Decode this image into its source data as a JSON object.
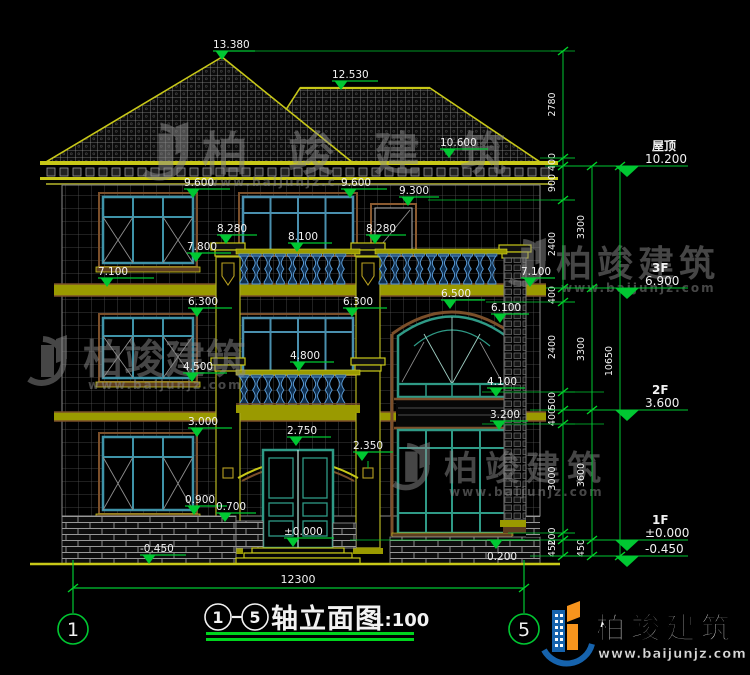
{
  "title": {
    "axis_from": "1",
    "axis_to": "5",
    "name": "轴立面图",
    "scale": "1:100"
  },
  "brand": {
    "name": "柏竣建筑",
    "url": "www.baijunjz.com",
    "url_short": "www.baijunjz.c"
  },
  "axes": [
    {
      "label": "1",
      "x": 73
    },
    {
      "label": "5",
      "x": 524
    }
  ],
  "floors": [
    {
      "name": "屋顶",
      "elev": "10.200",
      "line_y": 166
    },
    {
      "name": "3F",
      "elev": "6.900",
      "line_y": 288
    },
    {
      "name": "2F",
      "elev": "3.600",
      "line_y": 410
    },
    {
      "name": "1F",
      "elev": "±0.000",
      "line_y": 540
    },
    {
      "name": "",
      "elev": "-0.450",
      "line_y": 556
    }
  ],
  "markers": [
    {
      "label": "13.380",
      "x": 222,
      "y": 51,
      "len": 42
    },
    {
      "label": "12.530",
      "x": 341,
      "y": 81,
      "len": 46
    },
    {
      "label": "10.600",
      "x": 449,
      "y": 149,
      "len": 48
    },
    {
      "label": "9.600",
      "x": 193,
      "y": 189,
      "len": 46
    },
    {
      "label": "9.600",
      "x": 350,
      "y": 189,
      "len": 46
    },
    {
      "label": "9.300",
      "x": 408,
      "y": 197,
      "len": 40
    },
    {
      "label": "8.280",
      "x": 226,
      "y": 235,
      "len": 40
    },
    {
      "label": "8.100",
      "x": 297,
      "y": 243,
      "len": 44
    },
    {
      "label": "8.280",
      "x": 375,
      "y": 235,
      "len": 40
    },
    {
      "label": "7.800",
      "x": 196,
      "y": 253,
      "len": 44
    },
    {
      "label": "7.100",
      "x": 107,
      "y": 278,
      "len": 56
    },
    {
      "label": "7.100",
      "x": 530,
      "y": 278,
      "len": 34
    },
    {
      "label": "6.300",
      "x": 197,
      "y": 308,
      "len": 44
    },
    {
      "label": "6.500",
      "x": 450,
      "y": 300,
      "len": 44
    },
    {
      "label": "6.300",
      "x": 352,
      "y": 308,
      "len": 44
    },
    {
      "label": "6.100",
      "x": 500,
      "y": 314,
      "len": 38
    },
    {
      "label": "4.800",
      "x": 299,
      "y": 362,
      "len": 44
    },
    {
      "label": "4.500",
      "x": 192,
      "y": 373,
      "len": 44
    },
    {
      "label": "4.100",
      "x": 496,
      "y": 388,
      "len": 38
    },
    {
      "label": "3.200",
      "x": 499,
      "y": 421,
      "len": 38
    },
    {
      "label": "3.000",
      "x": 197,
      "y": 428,
      "len": 44
    },
    {
      "label": "2.750",
      "x": 296,
      "y": 437,
      "len": 44
    },
    {
      "label": "2.350",
      "x": 362,
      "y": 452,
      "len": 40
    },
    {
      "label": "0.900",
      "x": 194,
      "y": 506,
      "len": 42
    },
    {
      "label": "0.700",
      "x": 225,
      "y": 513,
      "len": 40
    },
    {
      "label": "±0.000",
      "x": 293,
      "y": 538,
      "len": 50
    },
    {
      "label": "-0.450",
      "x": 149,
      "y": 555,
      "len": 46
    },
    {
      "label": "0.200",
      "x": 496,
      "y": 540,
      "len": 38,
      "below": true
    }
  ],
  "dims": {
    "inner": [
      {
        "label": "2780",
        "y1": 51,
        "y2": 158
      },
      {
        "label": "400",
        "y1": 158,
        "y2": 166
      },
      {
        "label": "900",
        "y1": 166,
        "y2": 200
      },
      {
        "label": "2400",
        "y1": 200,
        "y2": 288
      },
      {
        "label": "400",
        "y1": 288,
        "y2": 302
      },
      {
        "label": "2400",
        "y1": 302,
        "y2": 392
      },
      {
        "label": "500",
        "y1": 392,
        "y2": 410
      },
      {
        "label": "400",
        "y1": 410,
        "y2": 424
      },
      {
        "label": "3000",
        "y1": 424,
        "y2": 533
      },
      {
        "label": "200",
        "y1": 533,
        "y2": 540
      },
      {
        "label": "450",
        "y1": 540,
        "y2": 556
      }
    ],
    "mid": [
      {
        "label": "3300",
        "y1": 166,
        "y2": 288
      },
      {
        "label": "3300",
        "y1": 288,
        "y2": 410
      },
      {
        "label": "3600",
        "y1": 410,
        "y2": 540
      },
      {
        "label": "450",
        "y1": 540,
        "y2": 556
      }
    ],
    "outer": [
      {
        "label": "10650",
        "y1": 166,
        "y2": 556
      }
    ],
    "total": {
      "label": "12300"
    }
  }
}
